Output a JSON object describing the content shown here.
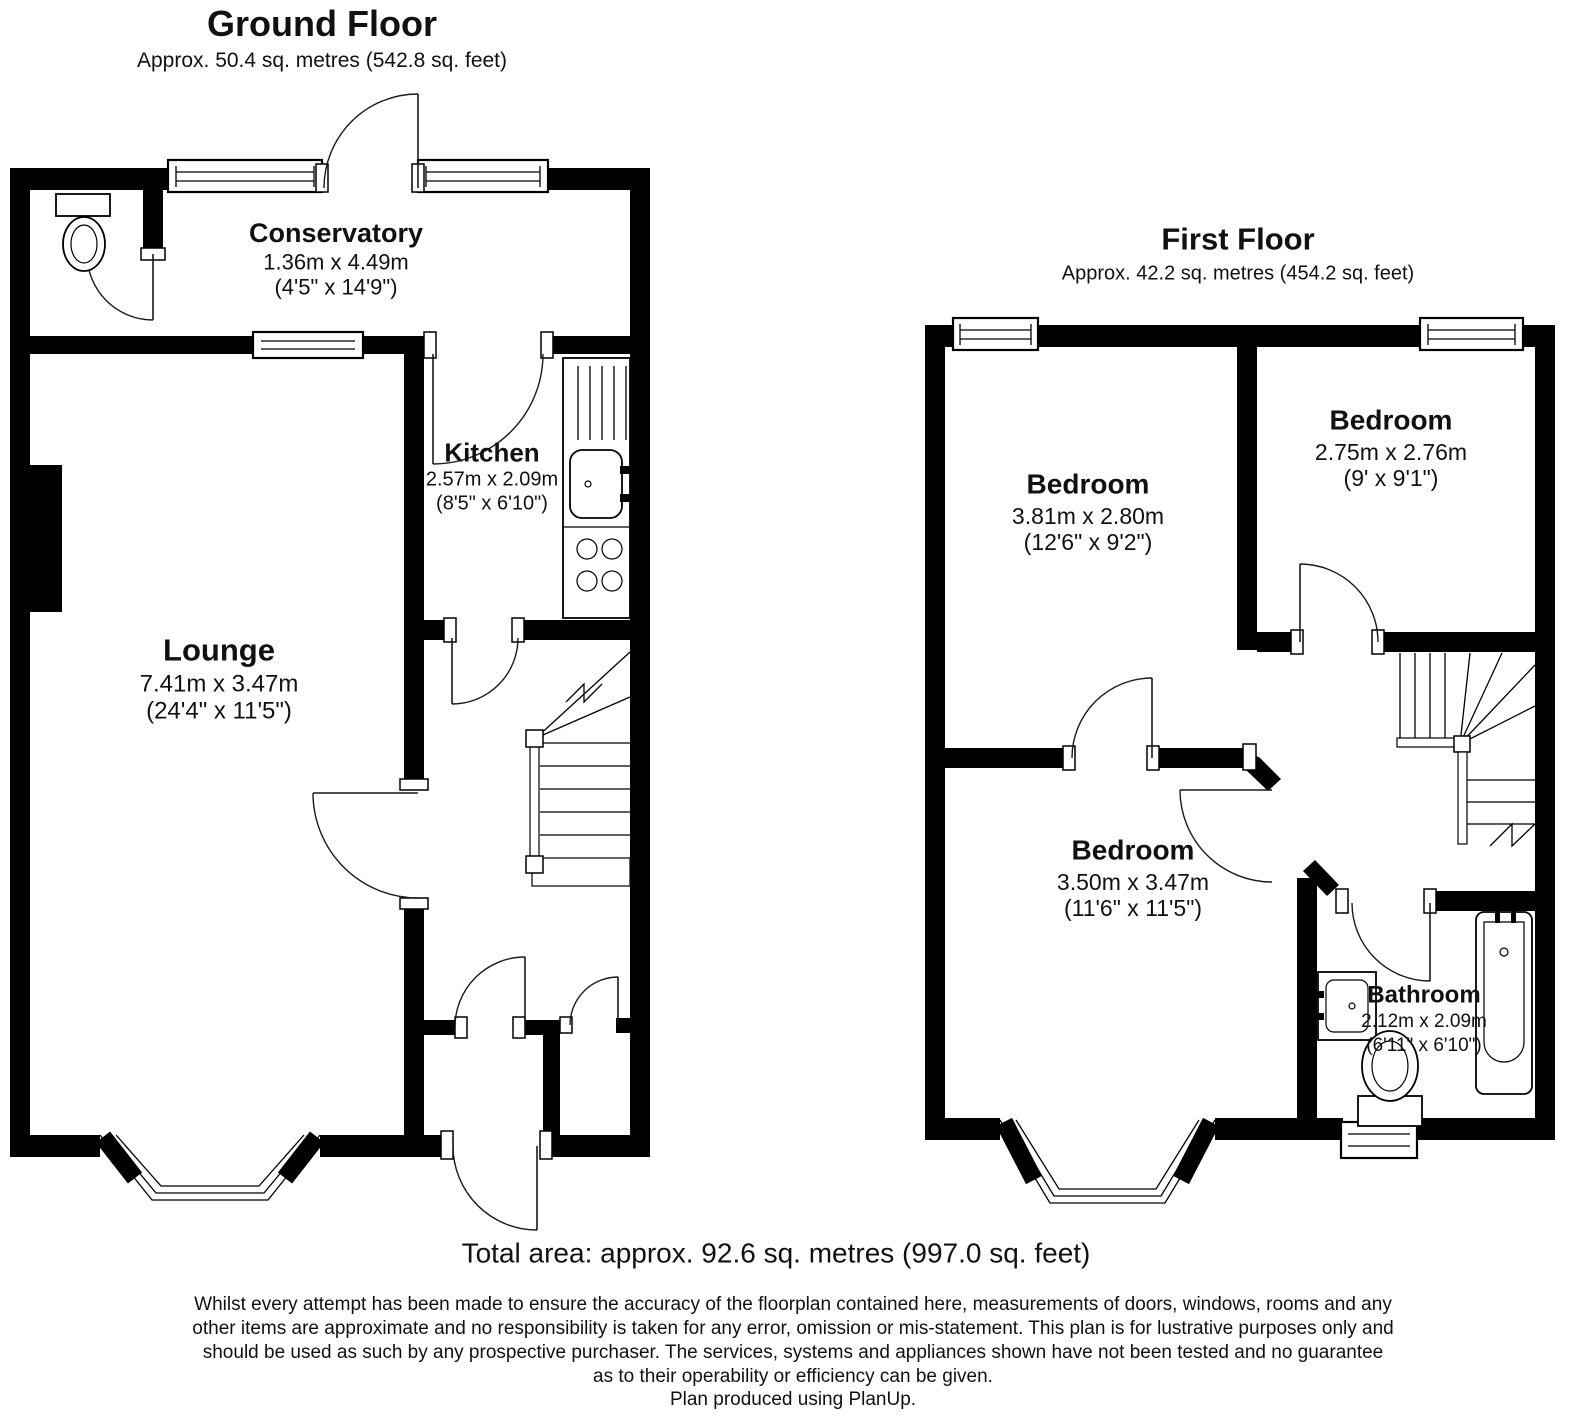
{
  "ground_floor": {
    "title": "Ground Floor",
    "subtitle": "Approx. 50.4 sq. metres (542.8 sq. feet)",
    "rooms": {
      "conservatory": {
        "name": "Conservatory",
        "metric": "1.36m x 4.49m",
        "imperial": "(4'5\" x 14'9\")"
      },
      "kitchen": {
        "name": "Kitchen",
        "metric": "2.57m x 2.09m",
        "imperial": "(8'5\" x 6'10\")"
      },
      "lounge": {
        "name": "Lounge",
        "metric": "7.41m x 3.47m",
        "imperial": "(24'4\" x 11'5\")"
      }
    }
  },
  "first_floor": {
    "title": "First Floor",
    "subtitle": "Approx. 42.2 sq. metres (454.2 sq. feet)",
    "rooms": {
      "bedroom_1": {
        "name": "Bedroom",
        "metric": "3.81m x 2.80m",
        "imperial": "(12'6\" x 9'2\")"
      },
      "bedroom_2": {
        "name": "Bedroom",
        "metric": "2.75m x 2.76m",
        "imperial": "(9' x 9'1\")"
      },
      "bedroom_3": {
        "name": "Bedroom",
        "metric": "3.50m x 3.47m",
        "imperial": "(11'6\" x 11'5\")"
      },
      "bathroom": {
        "name": "Bathroom",
        "metric": "2.12m x 2.09m",
        "imperial": "(6'11\" x 6'10\")"
      }
    }
  },
  "total_area": "Total area: approx. 92.6 sq. metres (997.0 sq. feet)",
  "disclaimer": {
    "lines": [
      "Whilst every attempt has been made to ensure the accuracy of the floorplan contained here, measurements of doors, windows, rooms and any",
      "other items are approximate and no responsibility is taken for any error, omission or mis-statement. This plan is for lustrative purposes only and",
      "should be used as such by any prospective purchaser. The services, systems and appliances shown have not been tested and no guarantee",
      "as to their operability or efficiency can be given."
    ]
  },
  "credit": "Plan produced using PlanUp.",
  "colors": {
    "wall": "#000000",
    "background": "#ffffff"
  }
}
